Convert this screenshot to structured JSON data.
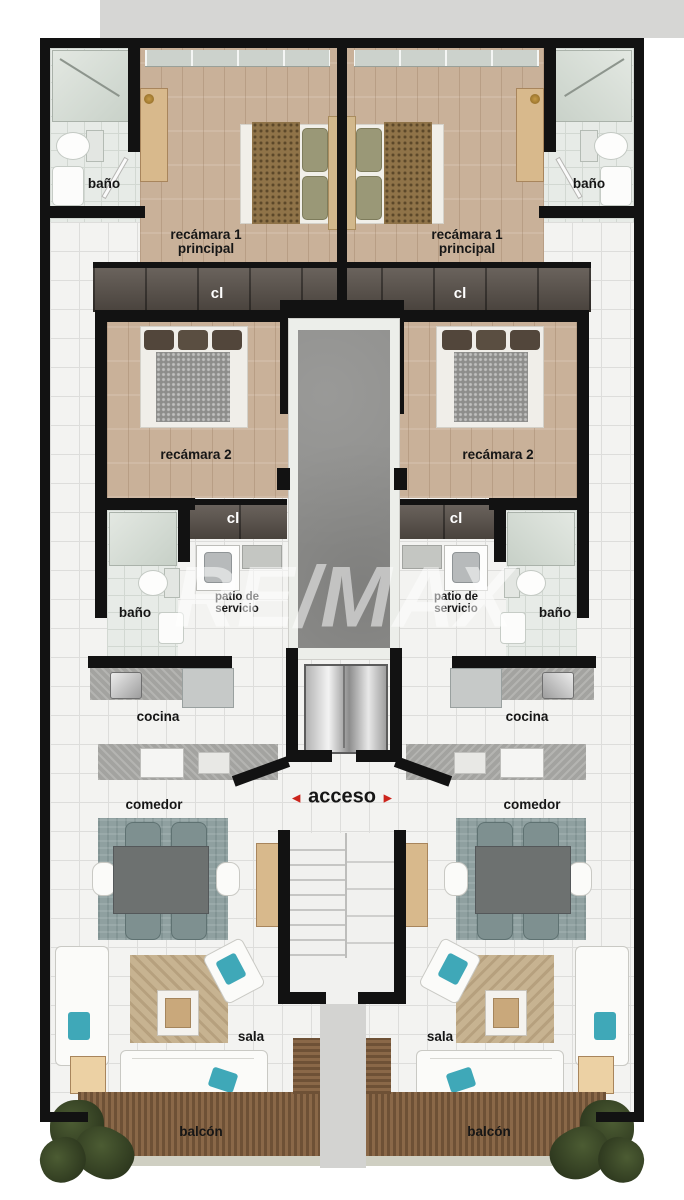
{
  "plan": {
    "watermark": "RE/MAX",
    "labels": {
      "bathroom": "baño",
      "master_bedroom_l1": "recámara 1",
      "master_bedroom_l2": "principal",
      "closet": "cl",
      "bedroom2": "recámara 2",
      "service_patio_l1": "patio de",
      "service_patio_l2": "servicio",
      "kitchen": "cocina",
      "dining_room": "comedor",
      "living_room": "sala",
      "balcony": "balcón",
      "access": "acceso",
      "arrow_left": "◄",
      "arrow_right": "►"
    },
    "colors": {
      "wall": "#121212",
      "tile_floor": "#f3f3f1",
      "tile_line": "#dddddb",
      "bath_tile": "#e7ebe7",
      "bath_line": "#d2d8d2",
      "wood_floor": "#c9b199",
      "wood_dark": "#59514a",
      "shaft": "#8e8e8c",
      "counter": "#a3a3a0",
      "rug_dining": "#8fa0a0",
      "rug_living": "#c7b391",
      "deck": "#7b5b3e",
      "door_tan": "#d8b98c",
      "teal_pillow": "#3fa8b8",
      "accent_red": "#cc241c",
      "exterior_gray": "#d6d6d4"
    }
  }
}
